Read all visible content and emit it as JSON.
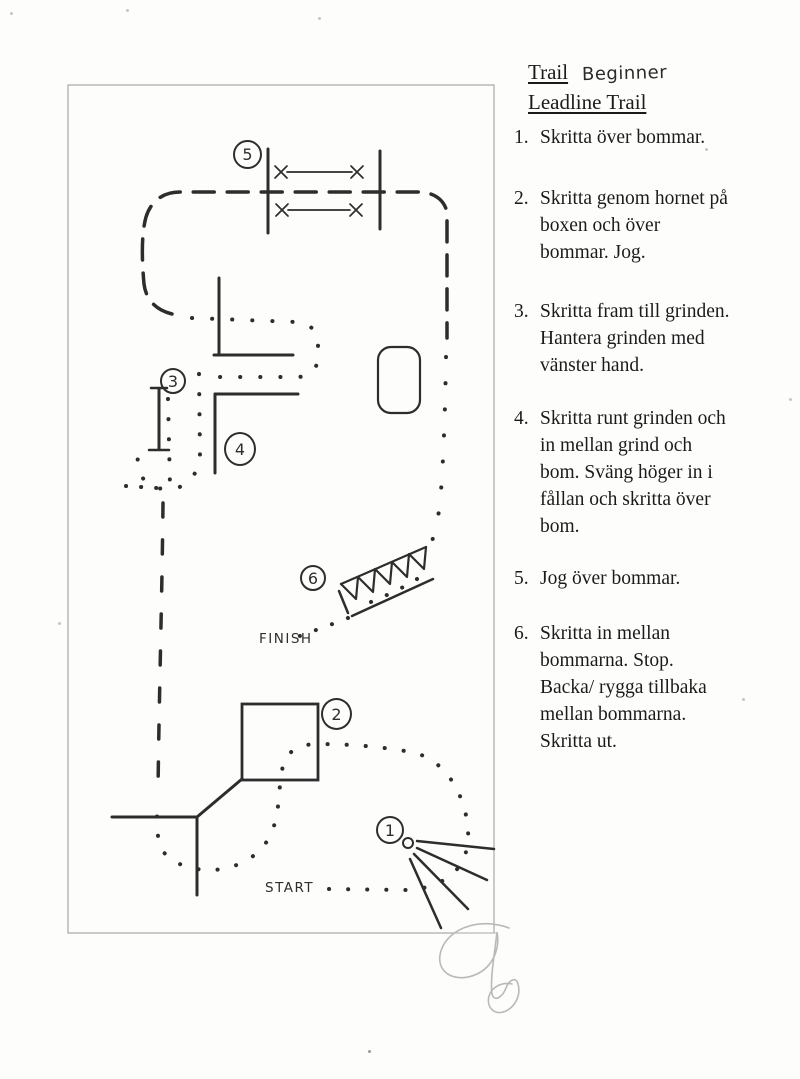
{
  "document": {
    "title": {
      "course_type": "Trail",
      "level": "Beginner",
      "subtitle": "Leadline Trail"
    },
    "instructions": [
      {
        "num": "1.",
        "text": "Skritta över bommar."
      },
      {
        "num": "2.",
        "text": "Skritta genom hornet på\nboxen och över\nbommar. Jog."
      },
      {
        "num": "3.",
        "text": "Skritta fram till grinden.\nHantera grinden med\nvänster hand."
      },
      {
        "num": "4.",
        "text": "Skritta runt grinden och\nin mellan grind och\nbom. Sväng höger in i\nfållan och skritta över\nbom."
      },
      {
        "num": "5.",
        "text": "Jog över bommar."
      },
      {
        "num": "6.",
        "text": "Skritta in mellan\nbommarna. Stop.\nBacka/ rygga tillbaka\nmellan bommarna.\nSkritta ut."
      }
    ],
    "diagram": {
      "labels": {
        "start": "START",
        "finish": "FINISH"
      },
      "obstacle_markers": [
        "1",
        "2",
        "3",
        "4",
        "5",
        "6"
      ],
      "colors": {
        "ink": "#2d2d2d",
        "paper": "#fdfdfc",
        "frame": "#a8a8a8",
        "signature": "#b9b9b9"
      }
    }
  }
}
